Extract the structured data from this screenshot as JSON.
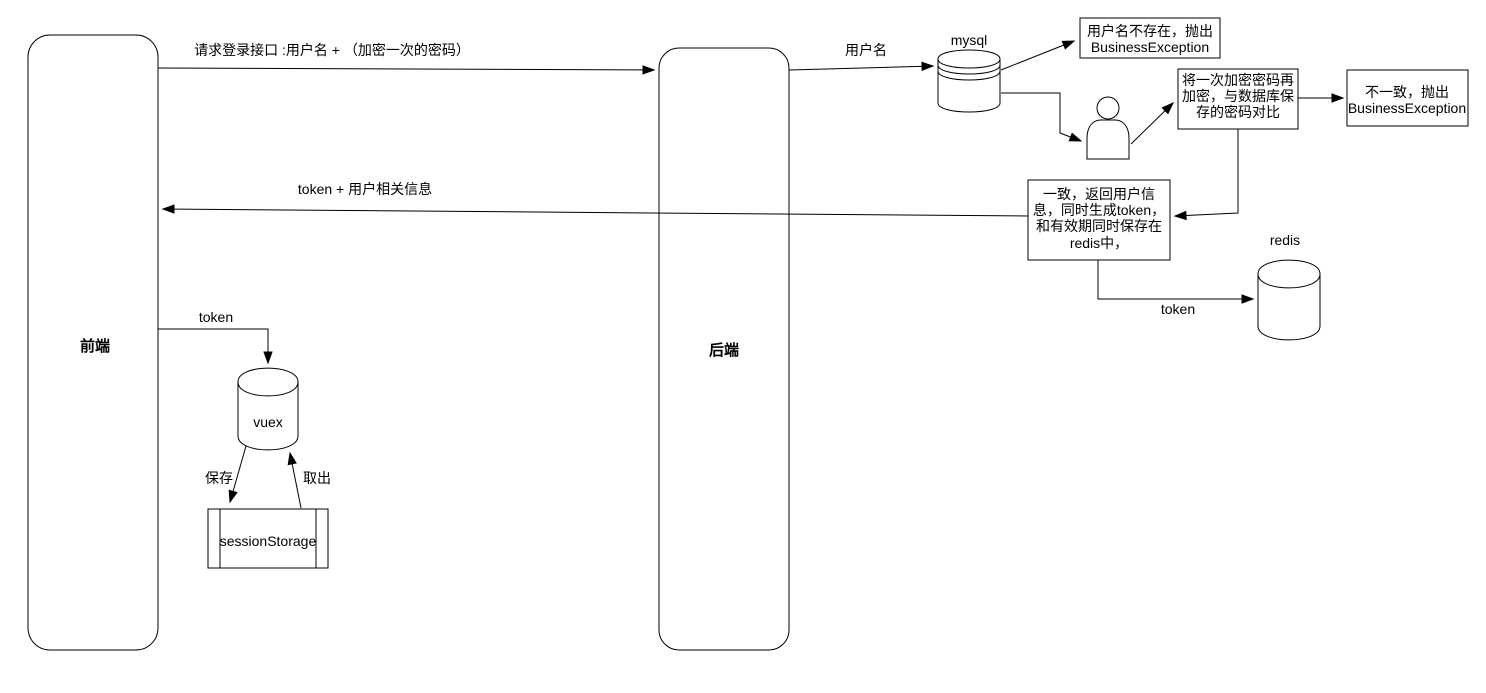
{
  "diagram": {
    "background_color": "#ffffff",
    "stroke_color": "#000000",
    "lifelines": {
      "frontend": {
        "label": "前端"
      },
      "backend": {
        "label": "后端"
      }
    },
    "datastores": {
      "mysql": {
        "label": "mysql"
      },
      "redis": {
        "label": "redis"
      },
      "vuex": {
        "label": "vuex"
      },
      "session_storage": {
        "label": "sessionStorage"
      }
    },
    "boxes": {
      "username_not_exist": {
        "lines": [
          "用户名不存在，抛出",
          "BusinessException"
        ]
      },
      "reencrypt_compare": {
        "lines": [
          "将一次加密密码再",
          "加密，与数据库保",
          "存的密码对比"
        ]
      },
      "password_mismatch": {
        "lines": [
          "不一致，抛出",
          "BusinessException"
        ]
      },
      "match_return_token": {
        "lines": [
          "一致，返回用户信",
          "息，同时生成token，",
          "和有效期同时保存在",
          "redis中，"
        ]
      }
    },
    "edges": {
      "login_request": {
        "label": "请求登录接口 :用户名 + （加密一次的密码）"
      },
      "username_query": {
        "label": "用户名"
      },
      "token_return": {
        "label": "token + 用户相关信息"
      },
      "token_to_vuex": {
        "label": "token"
      },
      "token_to_redis": {
        "label": "token"
      },
      "save_to_session": {
        "label": "保存"
      },
      "load_from_session": {
        "label": "取出"
      }
    }
  }
}
